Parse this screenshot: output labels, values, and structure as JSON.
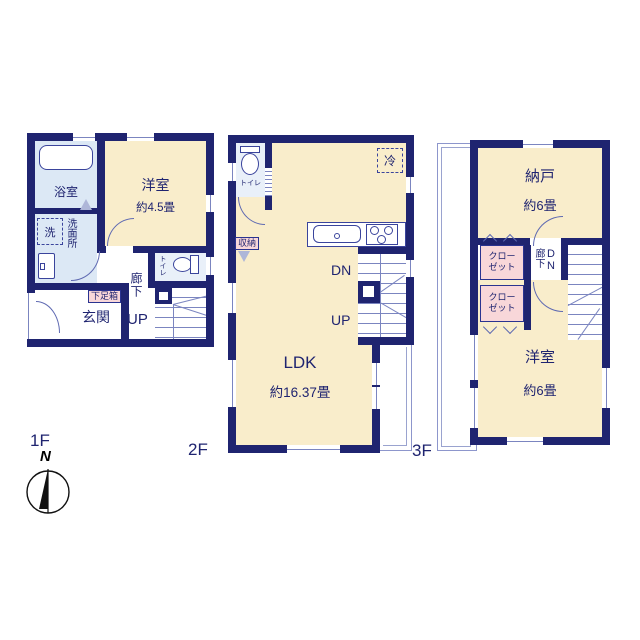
{
  "colors": {
    "wall_navy": "#1f2470",
    "room_cream": "#f9edcb",
    "wet_area_blue": "#dce8f5",
    "closet_pink": "#f8d7d9",
    "thin_line": "#8d96cc",
    "text_navy": "#1f2470"
  },
  "floor1": {
    "label": "1F",
    "bath": "浴室",
    "western_room": "洋室",
    "western_room_size": "約4.5畳",
    "washer": "洗",
    "washroom": "洗面所",
    "toilet": "トイレ",
    "shoe_cabinet": "下足箱",
    "entrance": "玄関",
    "hallway": "廊下",
    "up": "UP"
  },
  "floor2": {
    "label": "2F",
    "toilet": "トイレ",
    "refrigerator": "冷",
    "storage": "収納",
    "down": "DN",
    "up": "UP",
    "ldk": "LDK",
    "ldk_size": "約16.37畳"
  },
  "floor3": {
    "label": "3F",
    "storeroom": "納戸",
    "storeroom_size": "約6畳",
    "closet_a": "クローゼット",
    "closet_b": "クローゼット",
    "hallway": "廊下",
    "down": "DN",
    "western_room": "洋室",
    "western_room_size": "約6畳"
  },
  "compass": {
    "north": "N"
  }
}
